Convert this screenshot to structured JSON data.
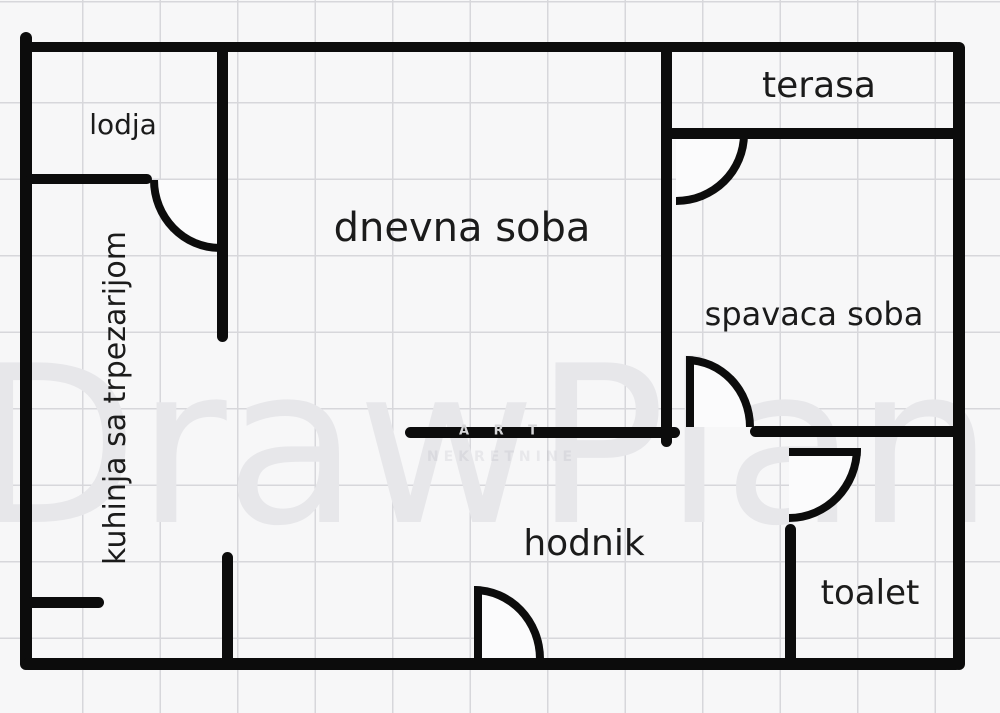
{
  "document": {
    "kind": "apartment floor plan"
  },
  "watermark": {
    "brand": "DrawPlan",
    "agency_line1": "A R T",
    "agency_line2": "NEKRETNINE"
  },
  "rooms": {
    "lodja": {
      "label": "lodja"
    },
    "dnevna_soba": {
      "label": "dnevna soba"
    },
    "terasa": {
      "label": "terasa"
    },
    "kuhinja": {
      "label": "kuhinja sa trpezarijom"
    },
    "spavaca_soba": {
      "label": "spavaca soba"
    },
    "hodnik": {
      "label": "hodnik"
    },
    "toalet": {
      "label": "toalet"
    }
  },
  "colors": {
    "wall": "#0c0c0c",
    "background": "#f7f7f8",
    "grid_line": "#d7d7db",
    "label_text": "#1b1b1b",
    "watermark_text": "#e7e7ea"
  }
}
